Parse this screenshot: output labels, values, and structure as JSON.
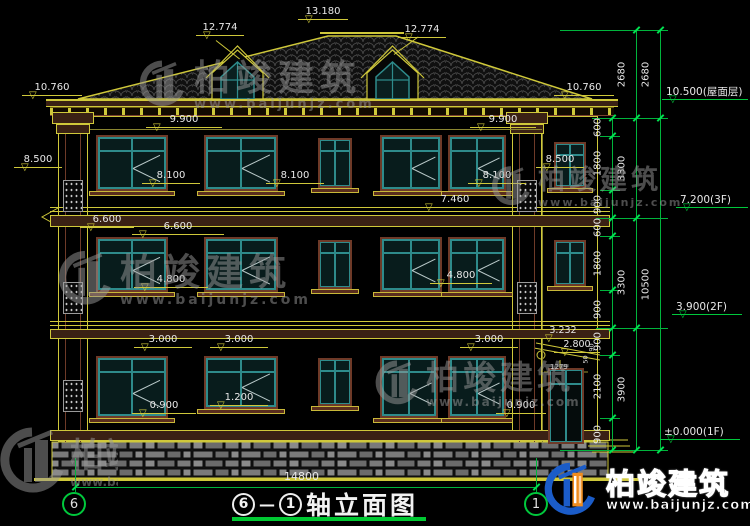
{
  "title": {
    "left_axis": "6",
    "right_axis": "1",
    "name": "轴立面图",
    "dash": "—"
  },
  "footer": {
    "total_width": "14800"
  },
  "levels": {
    "ridge": "13.180",
    "dormer": "12.774",
    "eave": "10.760",
    "pilaster_cap": "8.500",
    "w3_head": "9.900",
    "w3_sill": "8.100",
    "belt_top": "7.460",
    "w2_head": "6.600",
    "w2_sill": "4.800",
    "w1_head": "3.000",
    "w1_sill_a": "0.900",
    "w1_sill_b": "1.200",
    "canopy_top": "3.232",
    "canopy_eave": "2.800",
    "canopy_width": "1279",
    "n50": "50",
    "n90": "90"
  },
  "rchain": {
    "s600": "600",
    "s900": "900",
    "s1800": "1800",
    "s2100": "2100",
    "s2680": "2680",
    "s3300": "3300",
    "s3900": "3900",
    "s10500": "10500"
  },
  "rlevels": {
    "roof": "10.500(屋面层)",
    "f3": "7.200(3F)",
    "f2": "3.900(2F)",
    "f1": "±0.000(1F)"
  },
  "watermark": {
    "name": "柏竣建筑",
    "url": "www.baijunjz.com"
  },
  "brand": {
    "name": "柏竣建筑",
    "url": "www.baijunjz.com"
  },
  "icons": {
    "level_triangle": "▽"
  }
}
